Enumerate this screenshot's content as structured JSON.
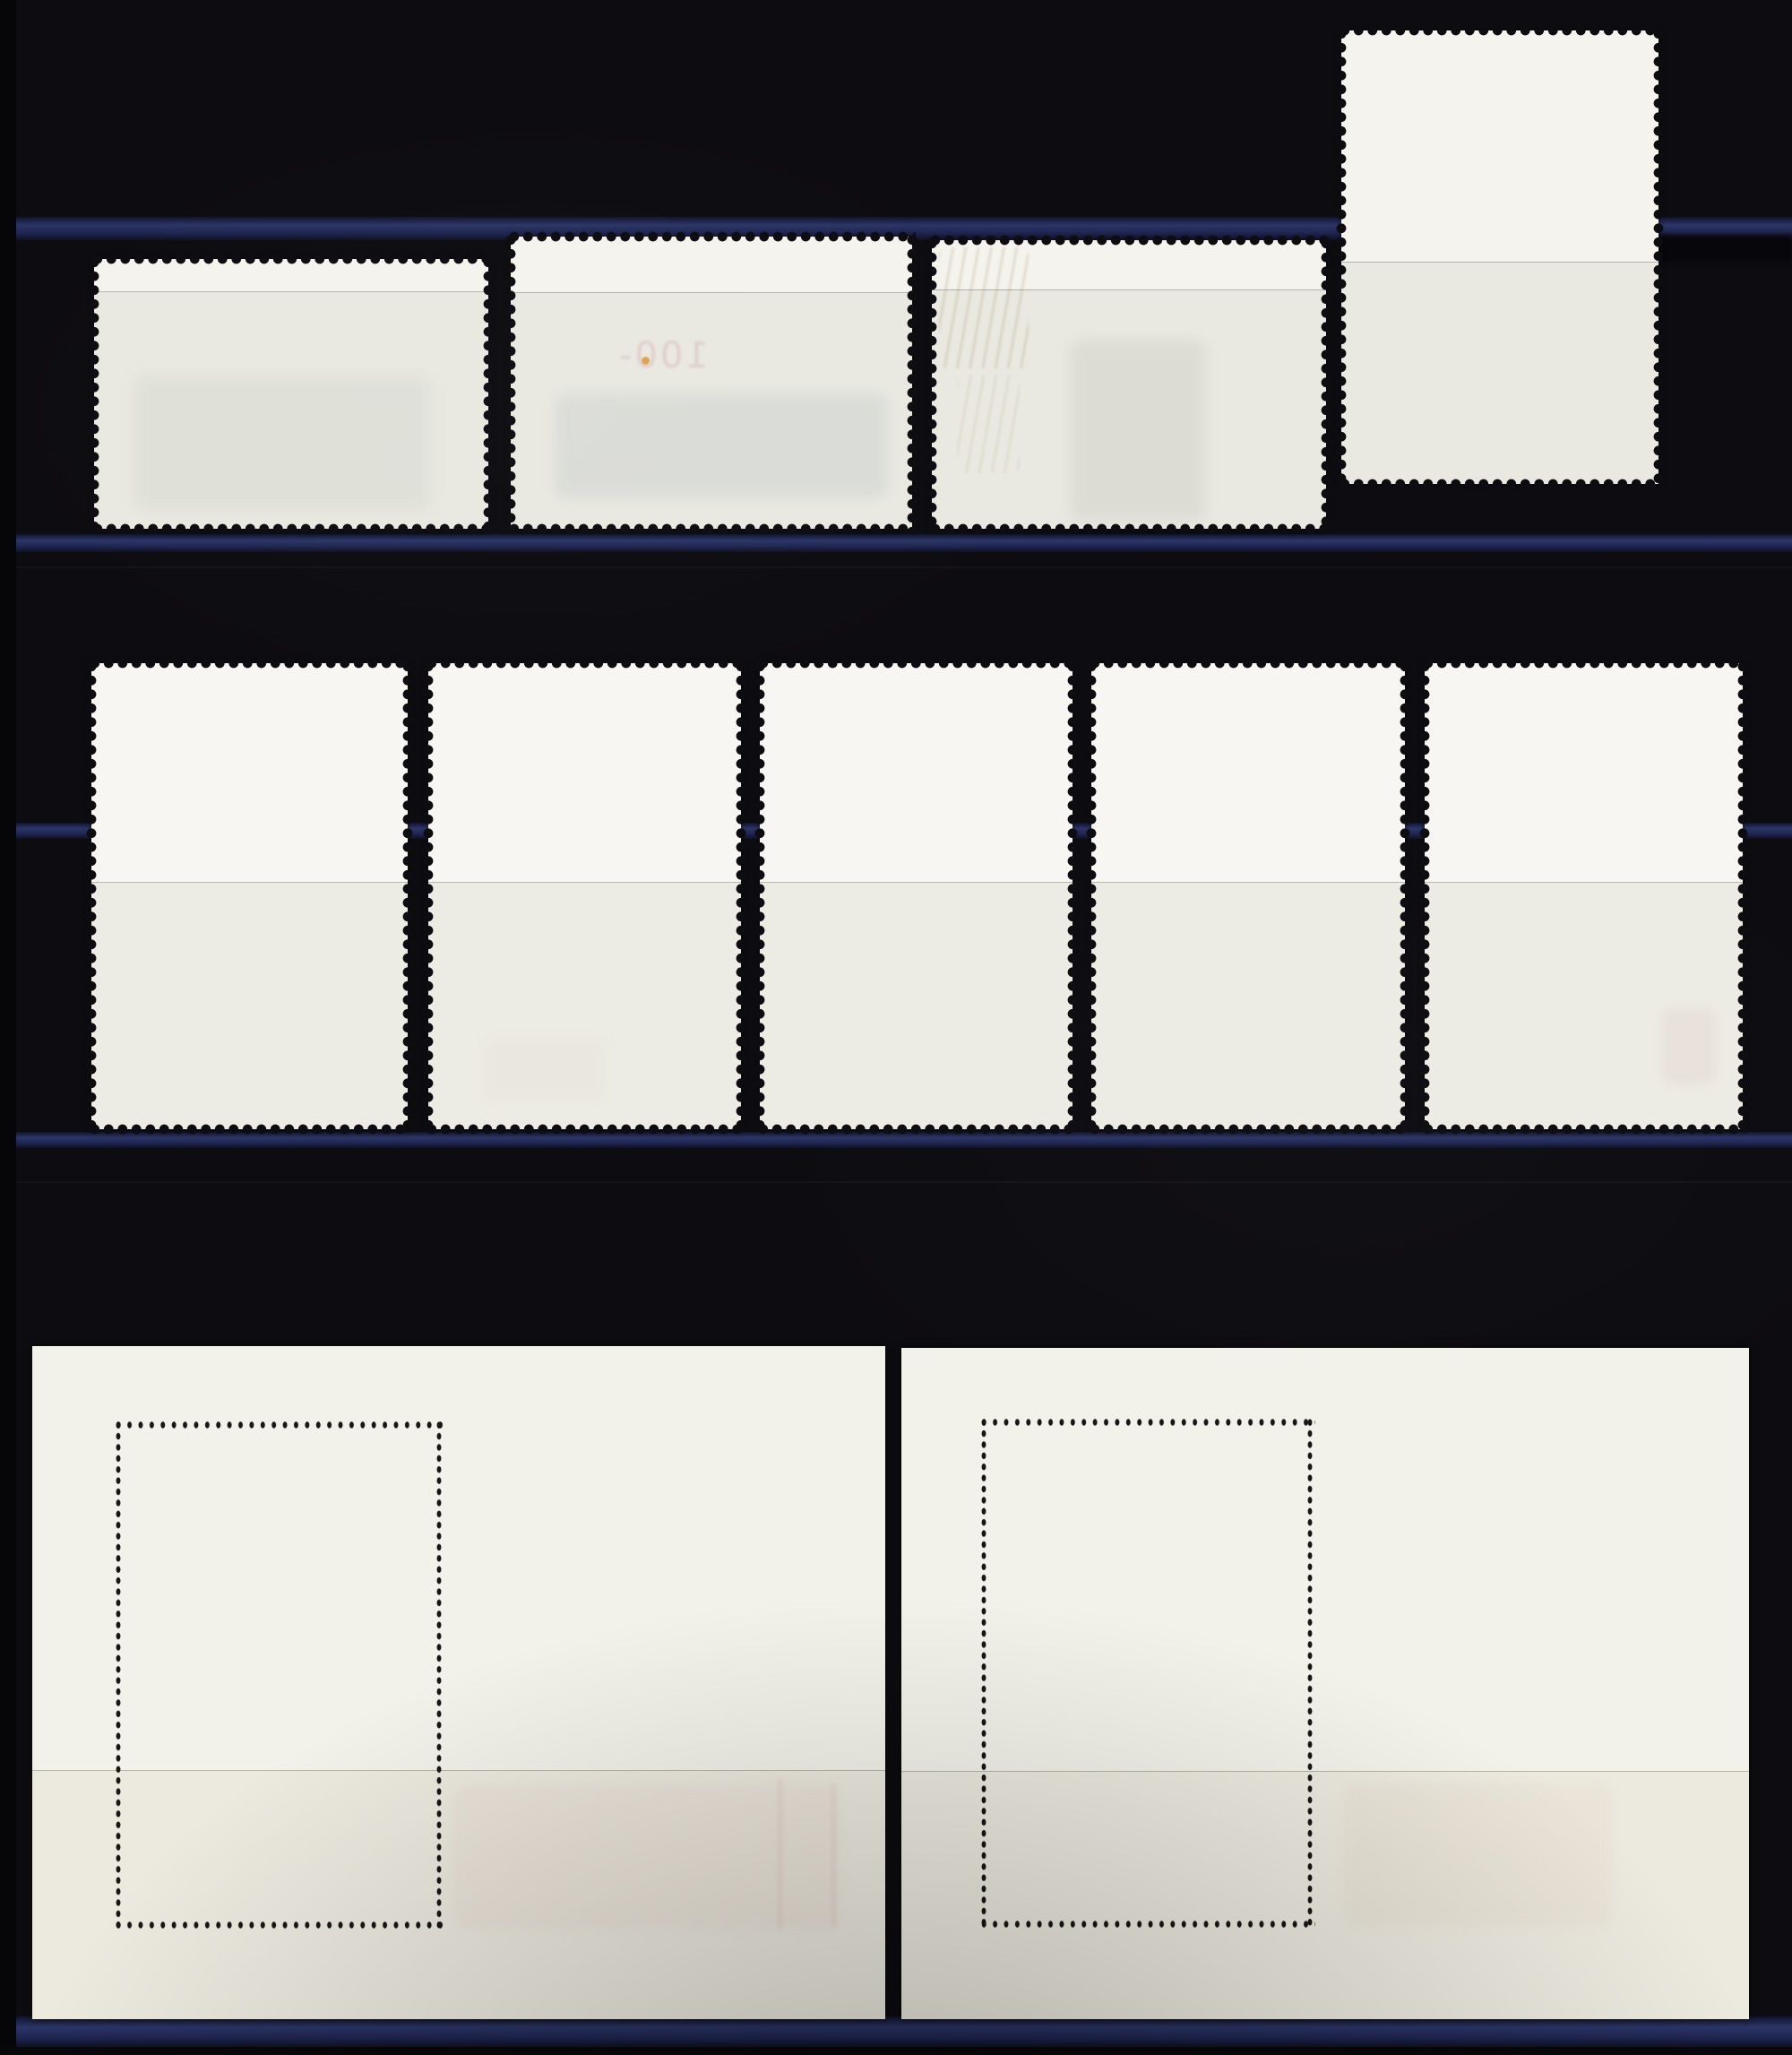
{
  "scene": {
    "description": "Photograph of a black stockbook album page displaying the gummed back sides of ten postage stamps and two souvenir sheets, held by navy-edged transparent film strips",
    "colors": {
      "background": "#0d0c10",
      "page_edge": "#060609",
      "strip_navy": "#1e2550",
      "strip_navy_highlight": "#2c3566",
      "stamp_paper_white": "#f4f3ee",
      "stamp_paper_shaded": "#e9e9e1",
      "middle_paper_white": "#f7f6f2",
      "middle_paper_shaded": "#edece4",
      "sheet_white": "#f3f2ea",
      "sheet_shaded": "#eceadf",
      "perforation_hole": "#0d0c10",
      "sheet_perforation_dot": "#161616",
      "postmark_trace_tan": "rgba(172,138,96,0.22)",
      "show_through_pink": "rgba(190,100,110,0.20)",
      "orange_fleck": "rgba(224,148,56,0.85)"
    },
    "counts": {
      "stamps_top_row": 4,
      "stamps_middle_row": 5,
      "souvenir_sheets": 2
    }
  },
  "ghosts": {
    "stamp2_text": "100-"
  },
  "items": [
    {
      "id": "stamp-1",
      "kind": "stamp-back",
      "row": "top",
      "orientation": "landscape",
      "label": "Stamp back, top row position 1, landscape, faint grey-green design show-through below film edge line"
    },
    {
      "id": "stamp-2",
      "kind": "stamp-back",
      "row": "top",
      "orientation": "landscape",
      "label": "Stamp back, top row position 2, landscape, faint mirrored 100- value show-through and small orange fleck"
    },
    {
      "id": "stamp-3",
      "kind": "stamp-back",
      "row": "top",
      "orientation": "landscape",
      "label": "Stamp back, top row position 3, landscape, faint tan postmark traces at top left and grey figure show-through"
    },
    {
      "id": "stamp-4",
      "kind": "stamp-back",
      "row": "top",
      "orientation": "portrait",
      "label": "Stamp back, top row position 4, tall portrait, clean white above film edge line"
    },
    {
      "id": "stamp-5",
      "kind": "stamp-back",
      "row": "middle",
      "orientation": "portrait",
      "label": "Stamp back, middle row position 1, portrait, blank"
    },
    {
      "id": "stamp-6",
      "kind": "stamp-back",
      "row": "middle",
      "orientation": "portrait",
      "label": "Stamp back, middle row position 2, portrait, blank with faint beige streak"
    },
    {
      "id": "stamp-7",
      "kind": "stamp-back",
      "row": "middle",
      "orientation": "portrait",
      "label": "Stamp back, middle row position 3, portrait, blank"
    },
    {
      "id": "stamp-8",
      "kind": "stamp-back",
      "row": "middle",
      "orientation": "portrait",
      "label": "Stamp back, middle row position 4, portrait, blank"
    },
    {
      "id": "stamp-9",
      "kind": "stamp-back",
      "row": "middle",
      "orientation": "portrait",
      "label": "Stamp back, middle row position 5, portrait, faint pink smudge lower right"
    },
    {
      "id": "sheet-1",
      "kind": "souvenir-sheet-back",
      "row": "bottom",
      "orientation": "landscape",
      "label": "Souvenir sheet back, bottom left, with dotted perforation outline of embedded stamp and faint pink streaks below film edge line"
    },
    {
      "id": "sheet-2",
      "kind": "souvenir-sheet-back",
      "row": "bottom",
      "orientation": "landscape",
      "label": "Souvenir sheet back, bottom right, with dotted perforation outline of embedded stamp"
    }
  ],
  "album": {
    "strip_edges": 5,
    "strip_edge_label": "Navy edge of transparent mounting strip"
  }
}
